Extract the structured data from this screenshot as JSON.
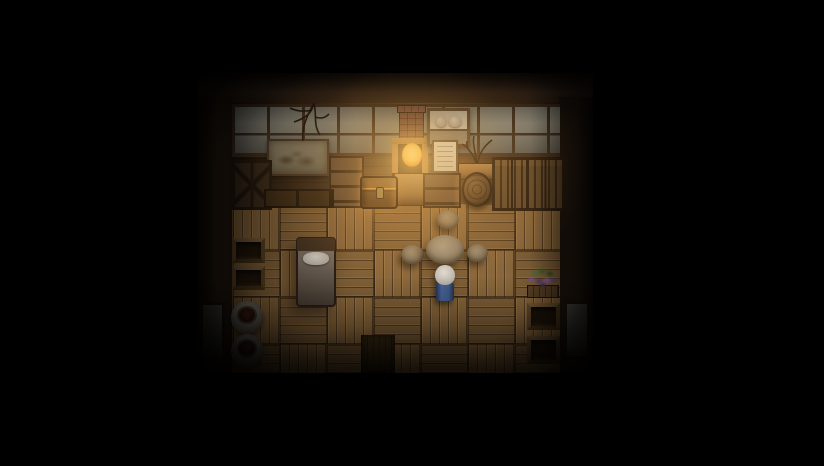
{
  "meta": {
    "kind": "game-viewport",
    "description": "Top-down RPG interior: rustic wooden house at night lit by a stove fire; elderly character in blue stands at a round table"
  },
  "colors": {
    "bg": "#000000",
    "frame-wood": "#42301f",
    "floor-a": "#8a673c",
    "floor-b": "#7f5f37",
    "brick": "#7c4c3c",
    "fire-core": "#ffe98f",
    "fire-mid": "#ffca4e",
    "fire-deep": "#e8912c",
    "pane": "#95958b",
    "char-body": "#3f5c8c",
    "char-hair": "#d8d3cc",
    "plant-purple": "#7b4fa0",
    "plant-green": "#47763a"
  },
  "scene": {
    "room": {
      "x": 198,
      "y": 73,
      "w": 395,
      "h": 300
    },
    "floor_tiles": {
      "size": 47,
      "cols": 7,
      "rows": 4
    },
    "objects": {
      "beam_top": {
        "x": 0,
        "y": 0,
        "w": 395,
        "h": 31
      },
      "pillar_left": {
        "x": 0,
        "y": 24,
        "w": 35,
        "h": 276
      },
      "pillar_right": {
        "x": 361,
        "y": 24,
        "w": 34,
        "h": 276
      },
      "wall": {
        "x": 34,
        "y": 30,
        "w": 328,
        "h": 101
      },
      "window_band": {
        "x": 34,
        "y": 31,
        "w": 328,
        "h": 46
      },
      "floor": {
        "x": 34,
        "y": 130,
        "w": 328,
        "h": 170
      },
      "painting": {
        "x": 69,
        "y": 66,
        "w": 58,
        "h": 33
      },
      "branch_top": {
        "x": 88,
        "y": 30,
        "w": 46,
        "h": 40
      },
      "cabinet_left": {
        "x": 34,
        "y": 87,
        "w": 34,
        "h": 44
      },
      "drawers_left": {
        "x": 131,
        "y": 83,
        "w": 31,
        "h": 48
      },
      "counter_drawers": {
        "x": 66,
        "y": 116,
        "w": 66,
        "h": 15
      },
      "chest": {
        "x": 162,
        "y": 103,
        "w": 34,
        "h": 29
      },
      "chimney": {
        "x": 201,
        "y": 33,
        "w": 23,
        "h": 33
      },
      "stove_body": {
        "x": 194,
        "y": 65,
        "w": 36,
        "h": 36
      },
      "fire": {
        "x": 204,
        "y": 70,
        "w": 20,
        "h": 24
      },
      "plank_cabinet": {
        "x": 196,
        "y": 100,
        "w": 29,
        "h": 31
      },
      "drawers_right": {
        "x": 225,
        "y": 100,
        "w": 34,
        "h": 31
      },
      "shelf_unit": {
        "x": 229,
        "y": 35,
        "w": 37,
        "h": 33
      },
      "paper": {
        "x": 234,
        "y": 67,
        "w": 26,
        "h": 33
      },
      "branches_decor": {
        "x": 262,
        "y": 63,
        "w": 34,
        "h": 32
      },
      "counter_right": {
        "x": 260,
        "y": 90,
        "w": 37,
        "h": 15
      },
      "barrel": {
        "x": 264,
        "y": 99,
        "w": 30,
        "h": 35
      },
      "cabinet_r1": {
        "x": 294,
        "y": 84,
        "w": 34,
        "h": 48
      },
      "cabinet_r2": {
        "x": 328,
        "y": 84,
        "w": 33,
        "h": 48
      },
      "bed": {
        "x": 98,
        "y": 164,
        "w": 36,
        "h": 66
      },
      "crate_l1": {
        "x": 34,
        "y": 165,
        "w": 33,
        "h": 25
      },
      "crate_l2": {
        "x": 34,
        "y": 193,
        "w": 33,
        "h": 24
      },
      "pot_l1": {
        "x": 33,
        "y": 228,
        "w": 32,
        "h": 33
      },
      "pot_l2": {
        "x": 33,
        "y": 261,
        "w": 32,
        "h": 34
      },
      "panel_left": {
        "x": 2,
        "y": 229,
        "w": 25,
        "h": 58
      },
      "panel_right": {
        "x": 366,
        "y": 228,
        "w": 26,
        "h": 58
      },
      "table": {
        "x": 228,
        "y": 162,
        "w": 38,
        "h": 29
      },
      "stool_top": {
        "x": 239,
        "y": 137,
        "w": 22,
        "h": 19
      },
      "stool_left": {
        "x": 203,
        "y": 172,
        "w": 23,
        "h": 19
      },
      "stool_right": {
        "x": 269,
        "y": 171,
        "w": 21,
        "h": 18
      },
      "character": {
        "x": 236,
        "y": 192,
        "w": 22,
        "h": 36
      },
      "plant": {
        "x": 328,
        "y": 193,
        "w": 34,
        "h": 32
      },
      "crate_r1": {
        "x": 329,
        "y": 230,
        "w": 33,
        "h": 27
      },
      "crate_r2": {
        "x": 329,
        "y": 263,
        "w": 33,
        "h": 28
      },
      "mat": {
        "x": 163,
        "y": 262,
        "w": 34,
        "h": 38
      }
    },
    "entities": {
      "character": {
        "label": "white-haired villager in blue, facing up toward table"
      }
    }
  }
}
